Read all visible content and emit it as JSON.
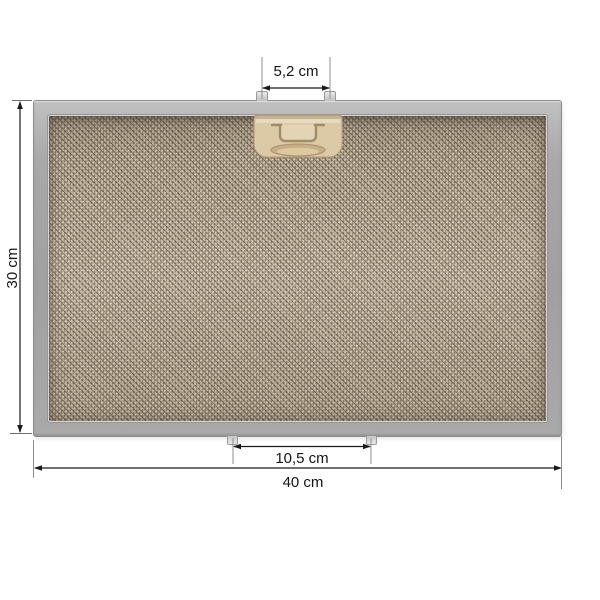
{
  "figure": {
    "type": "product-dimension-diagram",
    "subject": "metal-mesh-grease-filter"
  },
  "annotations": {
    "top_pin_spacing": "5,2 cm",
    "height": "30 cm",
    "bottom_pin_spacing": "10,5 cm",
    "width": "40 cm"
  },
  "colors": {
    "background": "#ffffff",
    "frame": "#a9a9a9",
    "mesh_base": "#b3a48b",
    "mesh_dark_speckle": "#4a3c2e",
    "mesh_light_speckle": "#e8dfc9",
    "clip": "#dccaa6",
    "pin": "#d9d9d9",
    "dimension_line": "#1a1a1a",
    "extension_line": "#8f8f8f"
  }
}
